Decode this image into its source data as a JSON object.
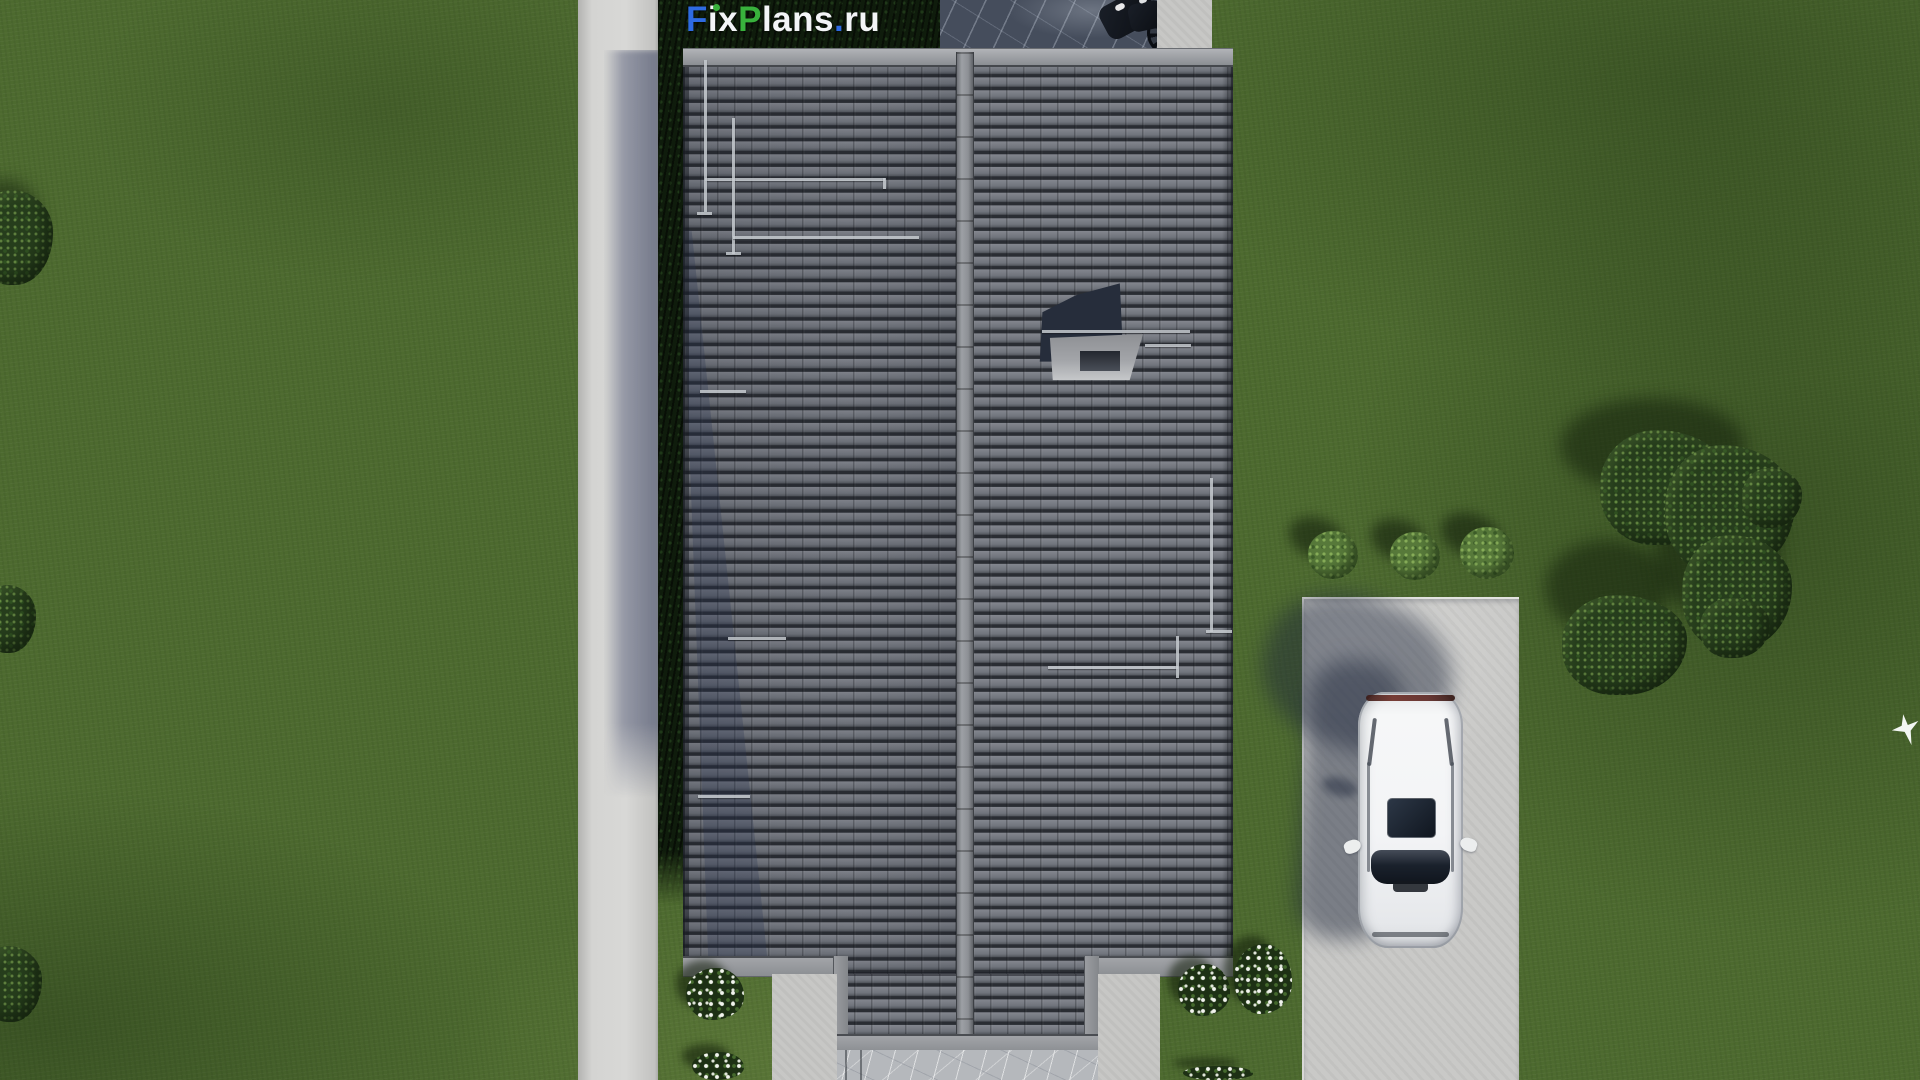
{
  "watermark": {
    "full_text": "FixPlans.ru",
    "f": "F",
    "ix": "ix",
    "p": "P",
    "lans": "lans",
    "dot": ".",
    "ru": "ru",
    "color_blue": "#2e6be2",
    "color_green": "#38b13c",
    "color_white": "#f3f5f7"
  },
  "scene": {
    "type": "aerial-top-down-3d-architectural-render",
    "elements": [
      "lawn",
      "concrete-footpath",
      "hedge-row",
      "stone-terrace",
      "parked-motorcycle",
      "gable-tiled-roof",
      "roof-ridge",
      "chimney-with-shadow",
      "snow-guard-rails",
      "entrance-walkway",
      "stone-entry-path",
      "flowering-bushes",
      "driveway",
      "white-car-top-view",
      "car-shadow",
      "round-bushes-row",
      "tree-cluster",
      "edge-trees",
      "flying-white-bird"
    ]
  },
  "palette": {
    "grass": "#4d6a2f",
    "concrete": "#cfcfcd",
    "roof_tile_light": "#83868e",
    "roof_tile_dark": "#2a2d33",
    "ridge": "#9da0a5",
    "hedge": "#0f1c0c",
    "stone_terrace": "#454d5c",
    "stone_path": "#b5b8bc",
    "shadow_blue": "#343d5e",
    "car_white": "#f3f4f6",
    "glass_dark": "#10161f"
  }
}
